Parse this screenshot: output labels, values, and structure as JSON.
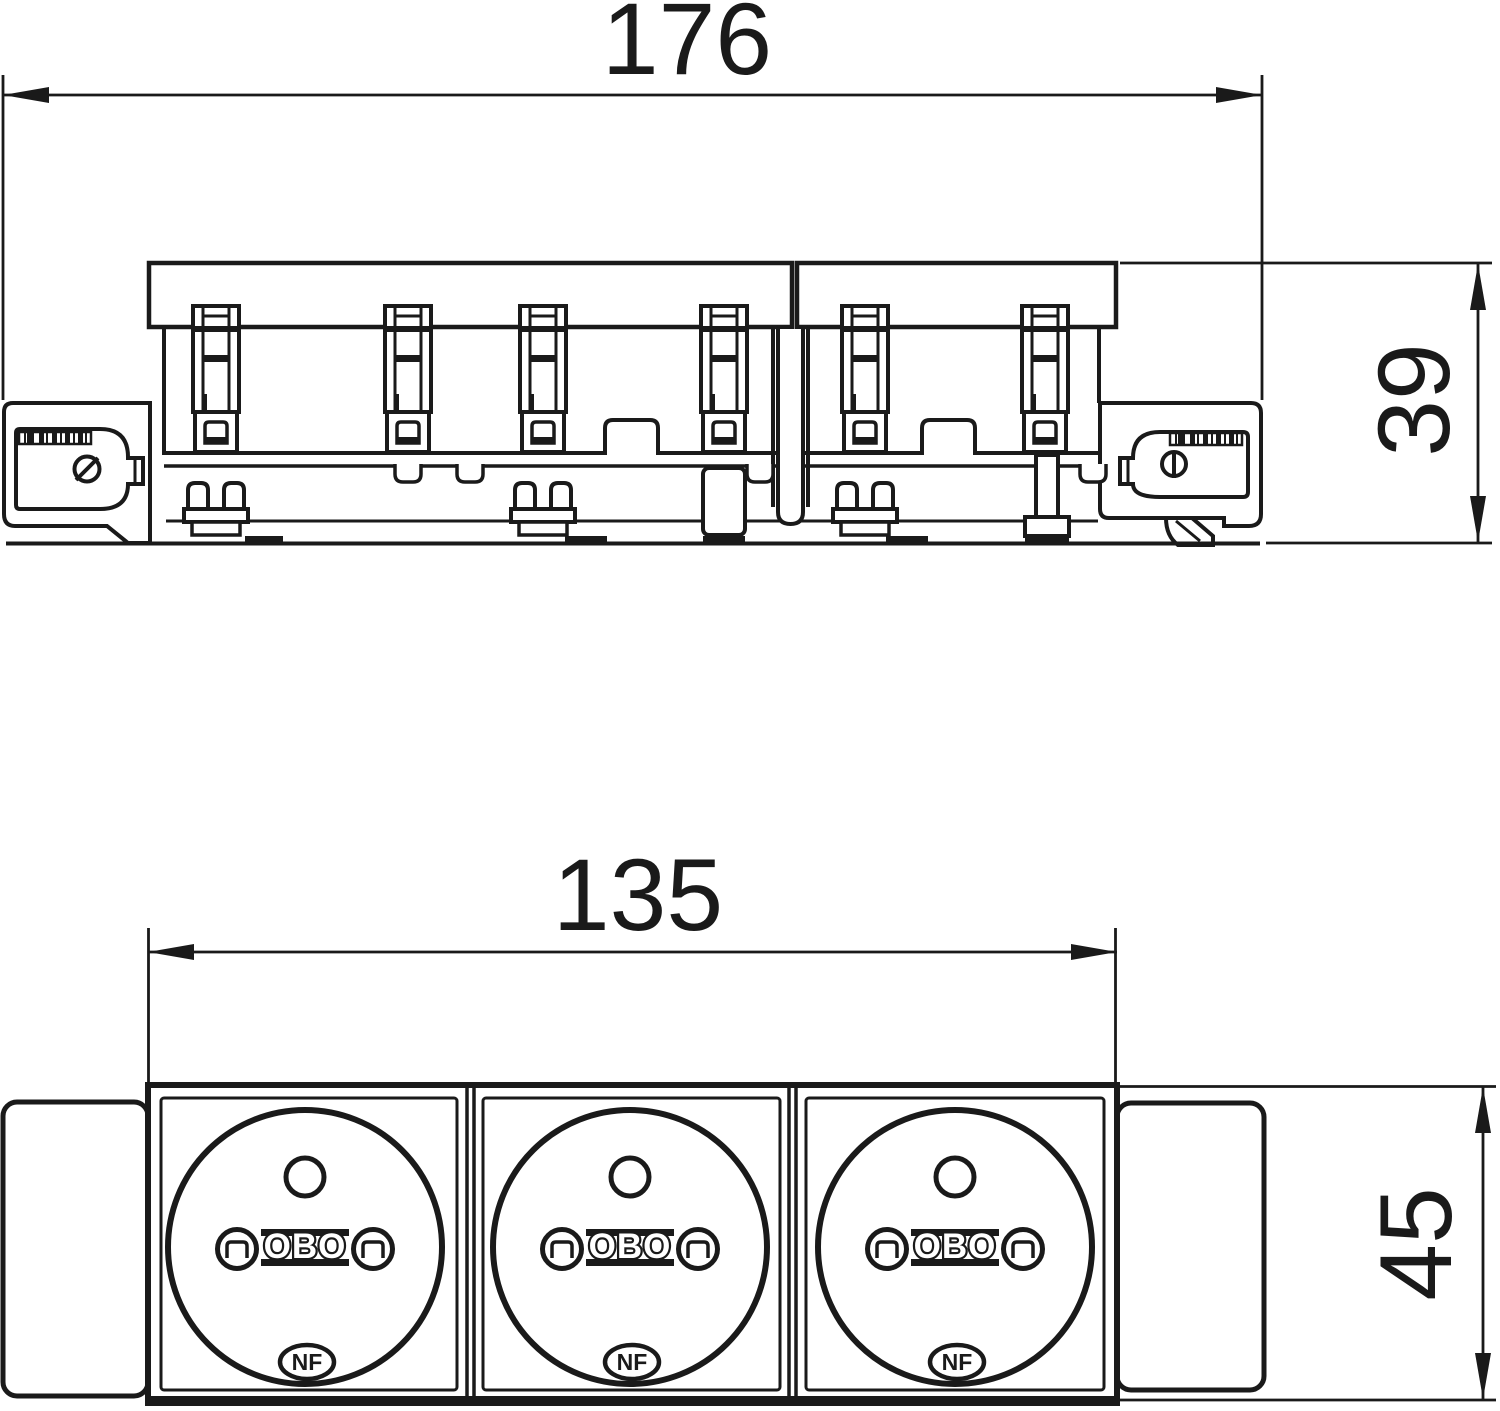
{
  "drawing": {
    "dimensions": {
      "top_view_width": "176",
      "top_view_height": "39",
      "front_view_width": "135",
      "front_view_height": "45"
    },
    "sockets": [
      {
        "brand": "OBO",
        "cert": "NF"
      },
      {
        "brand": "OBO",
        "cert": "NF"
      },
      {
        "brand": "OBO",
        "cert": "NF"
      }
    ],
    "colors": {
      "line": "#1a1a1a",
      "background": "#ffffff"
    }
  }
}
